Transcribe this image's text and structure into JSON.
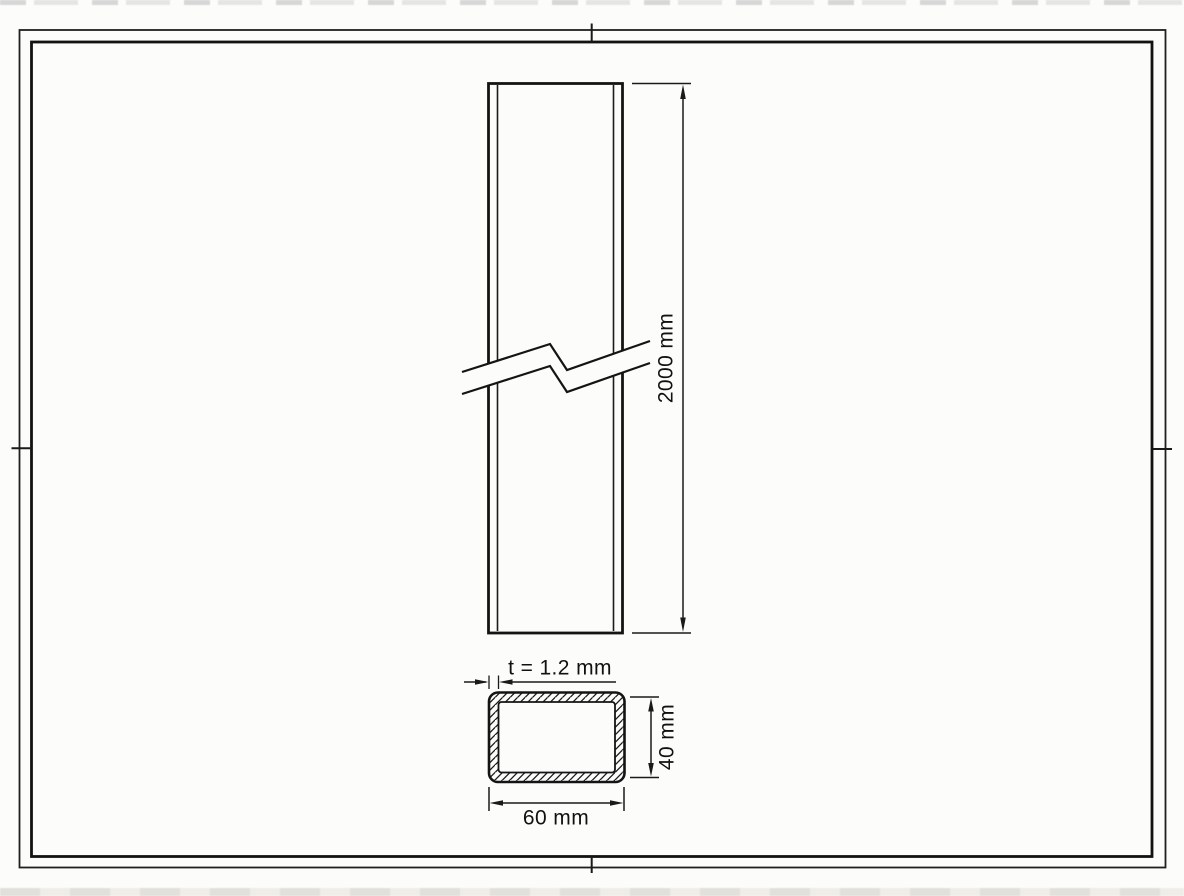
{
  "sheet": {
    "background_color": "#fcfcfa",
    "line_color": "#1a1a1a"
  },
  "views": {
    "elevation": {
      "length_label": "2000 mm"
    },
    "cross_section": {
      "thickness_label": "t = 1.2 mm",
      "height_label": "40 mm",
      "width_label": "60 mm"
    }
  }
}
